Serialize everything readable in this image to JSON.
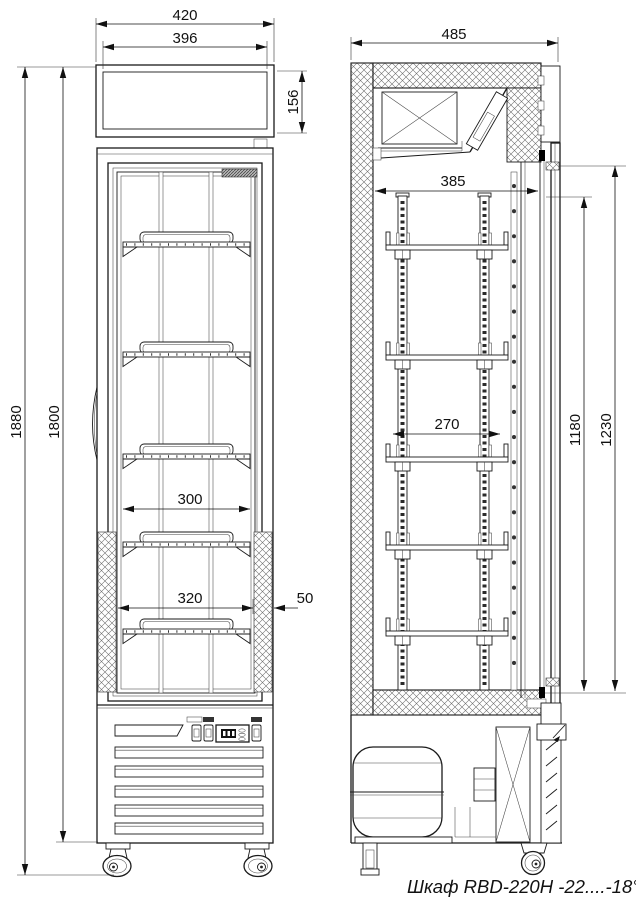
{
  "caption": "Шкаф RBD-220H -22....-18°C",
  "dims": {
    "front_overall_width": "420",
    "front_lightbox_width": "396",
    "front_lightbox_height": "156",
    "front_overall_height": "1880",
    "front_body_height": "1800",
    "front_shelf_width": "300",
    "front_opening_width": "320",
    "front_side_wall": "50",
    "side_overall_depth": "485",
    "side_interior_depth": "385",
    "side_shelf_depth": "270",
    "side_interior_height": "1180",
    "side_opening_height": "1230"
  }
}
